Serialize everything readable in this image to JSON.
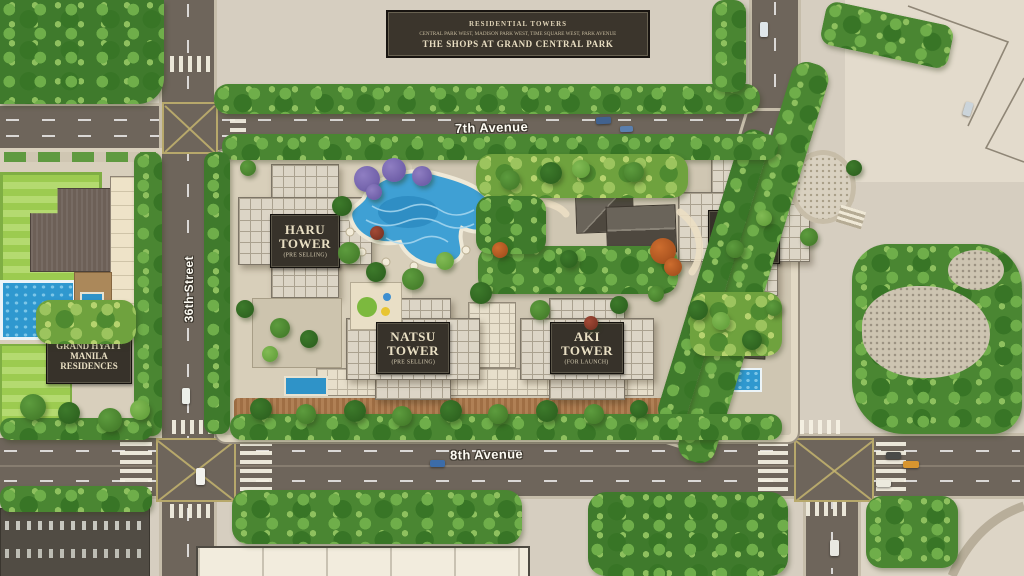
{
  "banner": {
    "title": "RESIDENTIAL TOWERS",
    "subtitle": "CENTRAL PARK WEST, MADISON PARK WEST, TIME SQUARE WEST, PARK AVENUE",
    "footer": "THE SHOPS AT GRAND CENTRAL PARK"
  },
  "streets": {
    "top_avenue": "7th Avenue",
    "bottom_avenue": "8th Avenue",
    "left_street": "36th Street"
  },
  "towers": {
    "haru": {
      "name": "HARU",
      "word": "TOWER",
      "status": "(PRE SELLING)"
    },
    "fuyu": {
      "name": "FUYU",
      "word": "TOWER",
      "status": "(FOR LAUNCH)"
    },
    "natsu": {
      "name": "NATSU",
      "word": "TOWER",
      "status": "(PRE SELLING)"
    },
    "aki": {
      "name": "AKI",
      "word": "TOWER",
      "status": "(FOR LAUNCH)"
    }
  },
  "buildings": {
    "grand_hyatt": {
      "line1": "GRAND HYATT",
      "line2": "MANILA",
      "line3": "RESIDENCES"
    }
  },
  "colors": {
    "road": "#6e655b",
    "ground": "#d6cec0",
    "tree_dark": "#3f7a2c",
    "tree_light": "#7cb84e",
    "pool_blue": "#3fa0d4",
    "label_bg": "#37322a",
    "label_text": "#e9dfc3"
  }
}
